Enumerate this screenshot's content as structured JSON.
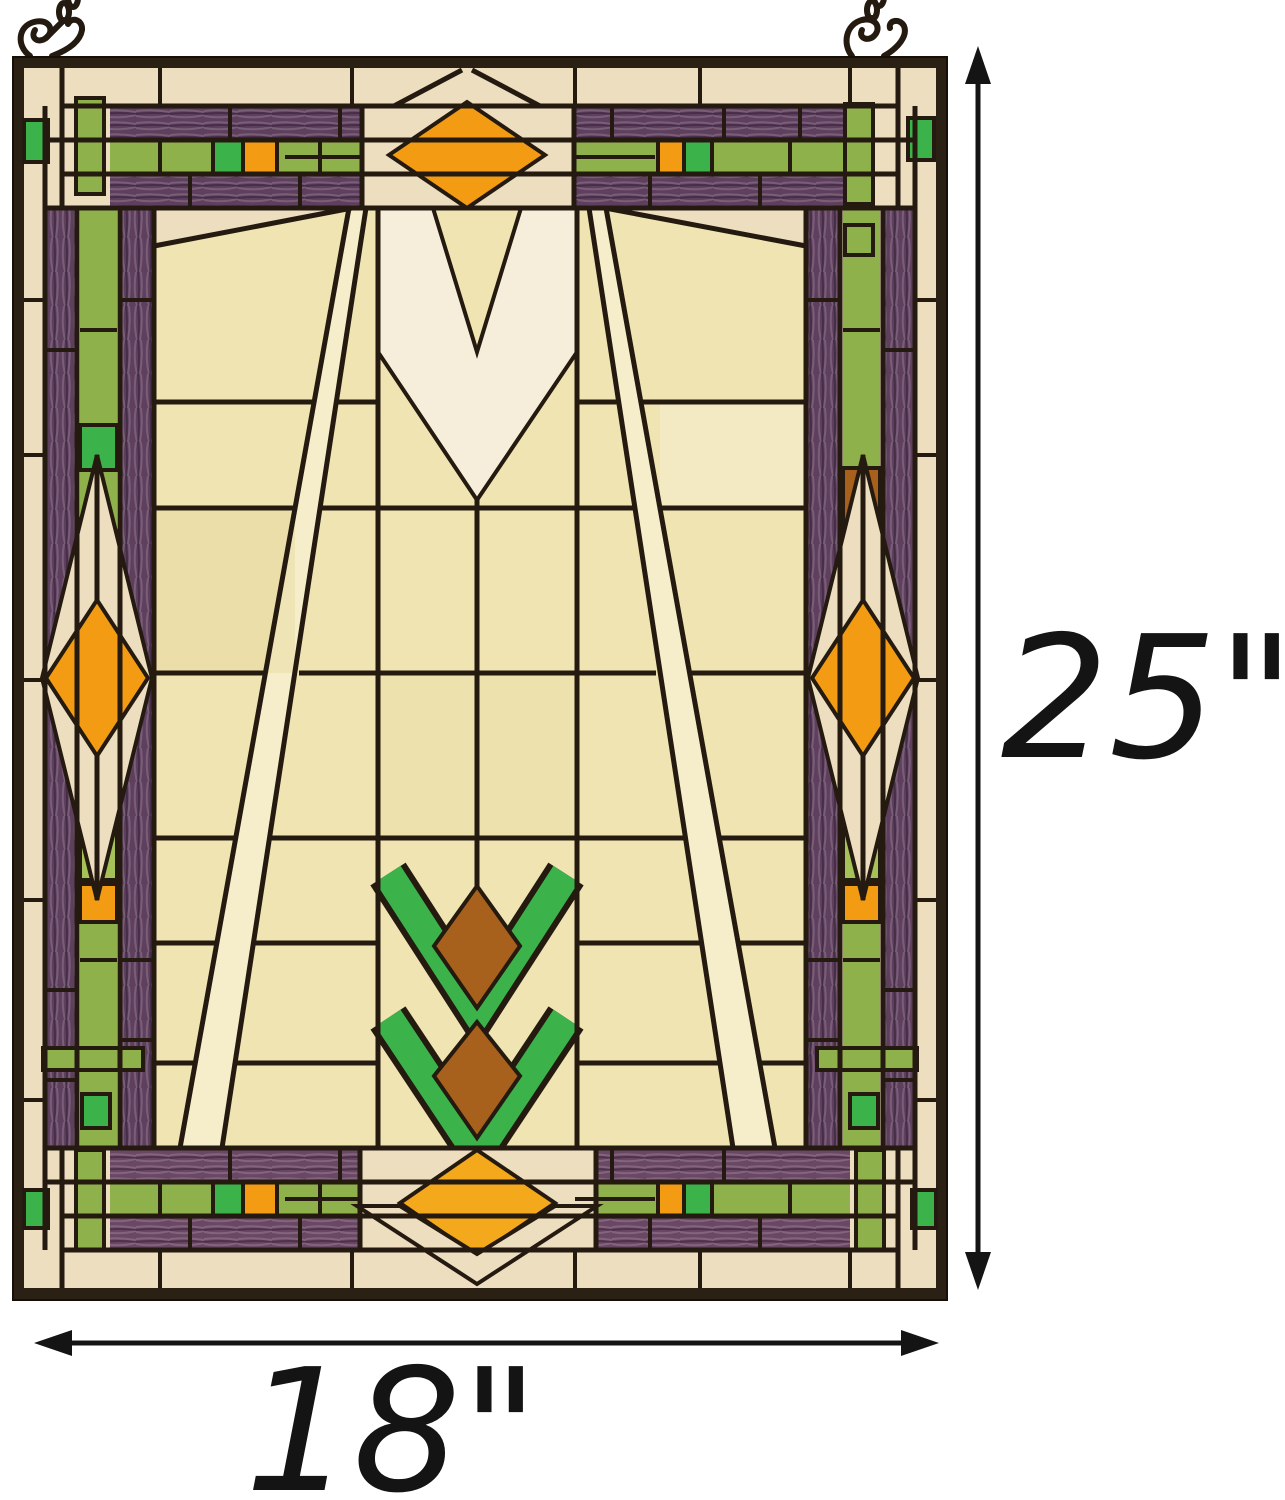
{
  "product": {
    "subject": "Mission style stained glass hanging window panel"
  },
  "annotations": {
    "height": {
      "label": "25\"",
      "value": 25
    },
    "width": {
      "label": "18\"",
      "value": 18
    }
  },
  "icons": {
    "hanging_hardware_left": "chain-scroll-hook-icon",
    "hanging_hardware_right": "chain-scroll-hook-icon",
    "height_arrow": "double-headed-vertical-arrow-icon",
    "width_arrow": "double-headed-horizontal-arrow-icon"
  },
  "palette": {
    "lead": "#241a10",
    "frame": "#2a2014",
    "cream": "#eddec0",
    "ivory": "#f6eeda",
    "field": "#efe4b2",
    "field_light": "#f6eecb",
    "purple": "#5f3f5e",
    "purple_light": "#8a5f78",
    "olive": "#8fb14b",
    "olive_light": "#a4c258",
    "green_bright": "#3bb34a",
    "orange": "#f39c13",
    "orange_bright": "#f4a81b",
    "amber": "#a8601d",
    "dimension": "#141414",
    "background": "#ffffff"
  }
}
